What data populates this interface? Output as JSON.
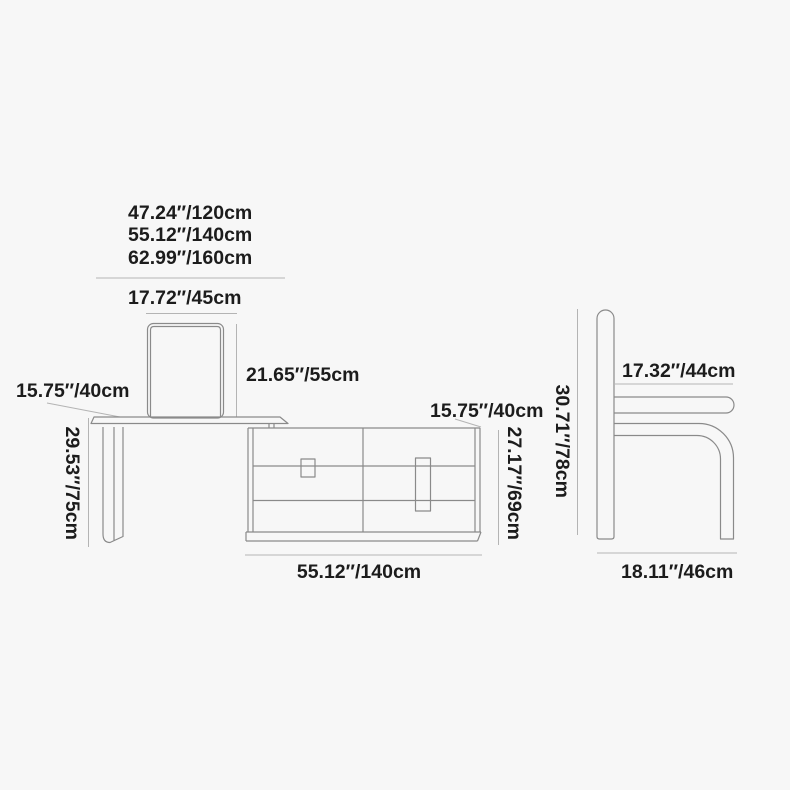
{
  "title": "Vanity desk with cabinet, mirror and chair — dimension diagram",
  "colors": {
    "background": "#f7f7f7",
    "furniture_line": "#8a8a8a",
    "dimension_line": "#b4b4b4",
    "text": "#1c1c1c"
  },
  "vanity": {
    "width_options": [
      "47.24″/120cm",
      "55.12″/140cm",
      "62.99″/160cm"
    ],
    "mirror_width": "17.72″/45cm",
    "mirror_height": "21.65″/55cm",
    "tabletop_depth": "15.75″/40cm",
    "desk_height": "29.53″/75cm",
    "cabinet_depth": "15.75″/40cm",
    "cabinet_height": "27.17″/69cm",
    "cabinet_width": "55.12″/140cm"
  },
  "chair": {
    "seat_width": "17.32″/44cm",
    "overall_height": "30.71″/78cm",
    "overall_depth": "18.11″/46cm"
  }
}
